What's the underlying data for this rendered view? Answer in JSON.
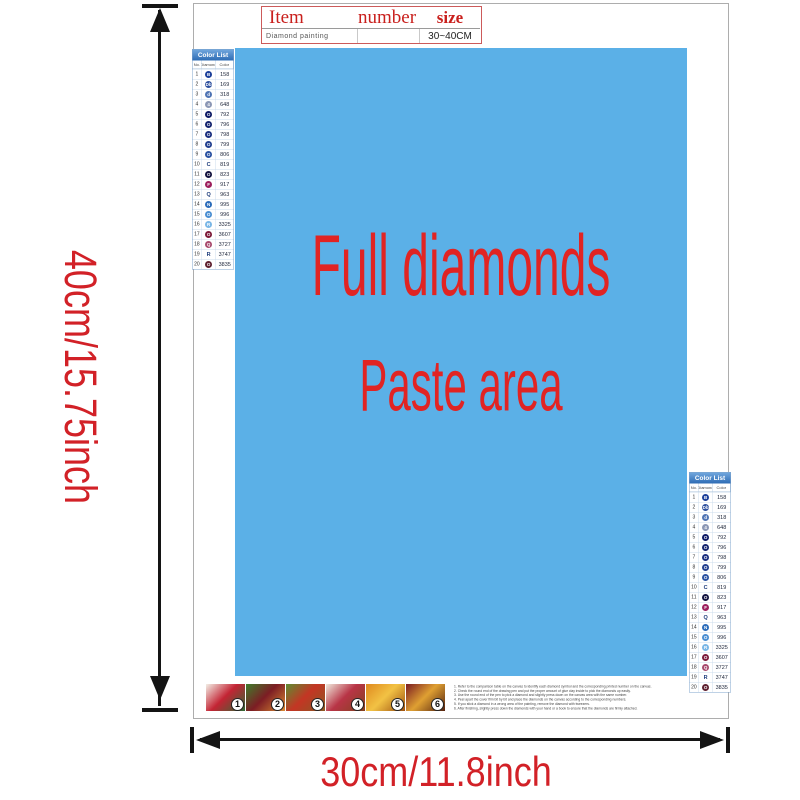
{
  "title_table": {
    "headers": [
      "Item",
      "number",
      "size"
    ],
    "row": {
      "item": "Diamond painting",
      "number": "",
      "size": "30~40CM"
    }
  },
  "paste_area": {
    "line1": "Full diamonds",
    "line2": "Paste area",
    "bg_color": "#5bb0e7",
    "text_color": "#e12423"
  },
  "dimensions": {
    "height_label": "40cm/15.75inch",
    "width_label": "30cm/11.8inch",
    "text_color": "#d22127",
    "arrow_color": "#141414"
  },
  "color_list": {
    "title": "Color List",
    "columns": [
      "No.",
      "Diamond",
      "Color"
    ],
    "rows": [
      {
        "no": "1",
        "symbol": "B",
        "code": "158",
        "color": "#1b3f9a",
        "style": "circle"
      },
      {
        "no": "2",
        "symbol": "Db",
        "code": "169",
        "color": "#2c4f9e",
        "style": "circle"
      },
      {
        "no": "3",
        "symbol": "d",
        "code": "318",
        "color": "#4f74b4",
        "style": "circle"
      },
      {
        "no": "4",
        "symbol": "4",
        "code": "648",
        "color": "#8b97b5",
        "style": "circle"
      },
      {
        "no": "5",
        "symbol": "O",
        "code": "792",
        "color": "#0d1a66",
        "style": "circle"
      },
      {
        "no": "6",
        "symbol": "O",
        "code": "796",
        "color": "#14246f",
        "style": "circle"
      },
      {
        "no": "7",
        "symbol": "O",
        "code": "798",
        "color": "#1a2f80",
        "style": "circle"
      },
      {
        "no": "8",
        "symbol": "O",
        "code": "799",
        "color": "#224090",
        "style": "circle"
      },
      {
        "no": "9",
        "symbol": "O",
        "code": "806",
        "color": "#2a52a2",
        "style": "circle"
      },
      {
        "no": "10",
        "symbol": "C",
        "code": "819",
        "color": "#1a3a7a",
        "style": "plain"
      },
      {
        "no": "11",
        "symbol": "O",
        "code": "823",
        "color": "#12123f",
        "style": "circle"
      },
      {
        "no": "12",
        "symbol": "F",
        "code": "917",
        "color": "#9c1f5e",
        "style": "circle"
      },
      {
        "no": "13",
        "symbol": "Q",
        "code": "963",
        "color": "#1a3a7a",
        "style": "plain"
      },
      {
        "no": "14",
        "symbol": "N",
        "code": "995",
        "color": "#2b6cba",
        "style": "circle"
      },
      {
        "no": "15",
        "symbol": "O",
        "code": "996",
        "color": "#4a8ed2",
        "style": "circle"
      },
      {
        "no": "16",
        "symbol": "R",
        "code": "3325",
        "color": "#79b6e6",
        "style": "circle"
      },
      {
        "no": "17",
        "symbol": "O",
        "code": "3607",
        "color": "#7c1a3a",
        "style": "circle"
      },
      {
        "no": "18",
        "symbol": "Q",
        "code": "3727",
        "color": "#a84a6e",
        "style": "circle"
      },
      {
        "no": "19",
        "symbol": "R",
        "code": "3747",
        "color": "#1a3a7a",
        "style": "plain"
      },
      {
        "no": "20",
        "symbol": "O",
        "code": "3835",
        "color": "#5e2030",
        "style": "circle"
      }
    ]
  },
  "thumbnails": [
    {
      "label": "1",
      "colors": [
        "#f2efe6",
        "#c32434",
        "#2f6b35"
      ]
    },
    {
      "label": "2",
      "colors": [
        "#3f7d2c",
        "#7c1d24",
        "#d98a33"
      ]
    },
    {
      "label": "3",
      "colors": [
        "#5d8d32",
        "#c43524",
        "#8a5a23"
      ]
    },
    {
      "label": "4",
      "colors": [
        "#efe9dc",
        "#b83446",
        "#84431f"
      ]
    },
    {
      "label": "5",
      "colors": [
        "#df8a1f",
        "#f2c244",
        "#9e5110"
      ]
    },
    {
      "label": "6",
      "colors": [
        "#7a1c22",
        "#dfa032",
        "#54220f"
      ]
    }
  ],
  "instructions": {
    "lines": [
      "1. Refer to the comparison table on the canvas to identify each diamond symbol and the corresponding printed number on the canvas.",
      "2. Check the round end of the drawing pen and put the proper amount of glue clay inside to pick the diamonds up easily.",
      "3. Use the round end of the pen to pick a diamond and slightly press down on the canvas area with the same number.",
      "4. Peel apart the cover film bit by bit and place the diamonds on the canvas according to the corresponding numbers.",
      "5. If you stick a diamond in a wrong area of the painting, remove the diamond with tweezers.",
      "6. After finishing, slightly press down the diamonds with your hand or a book to ensure that the diamonds are firmly attached."
    ]
  }
}
